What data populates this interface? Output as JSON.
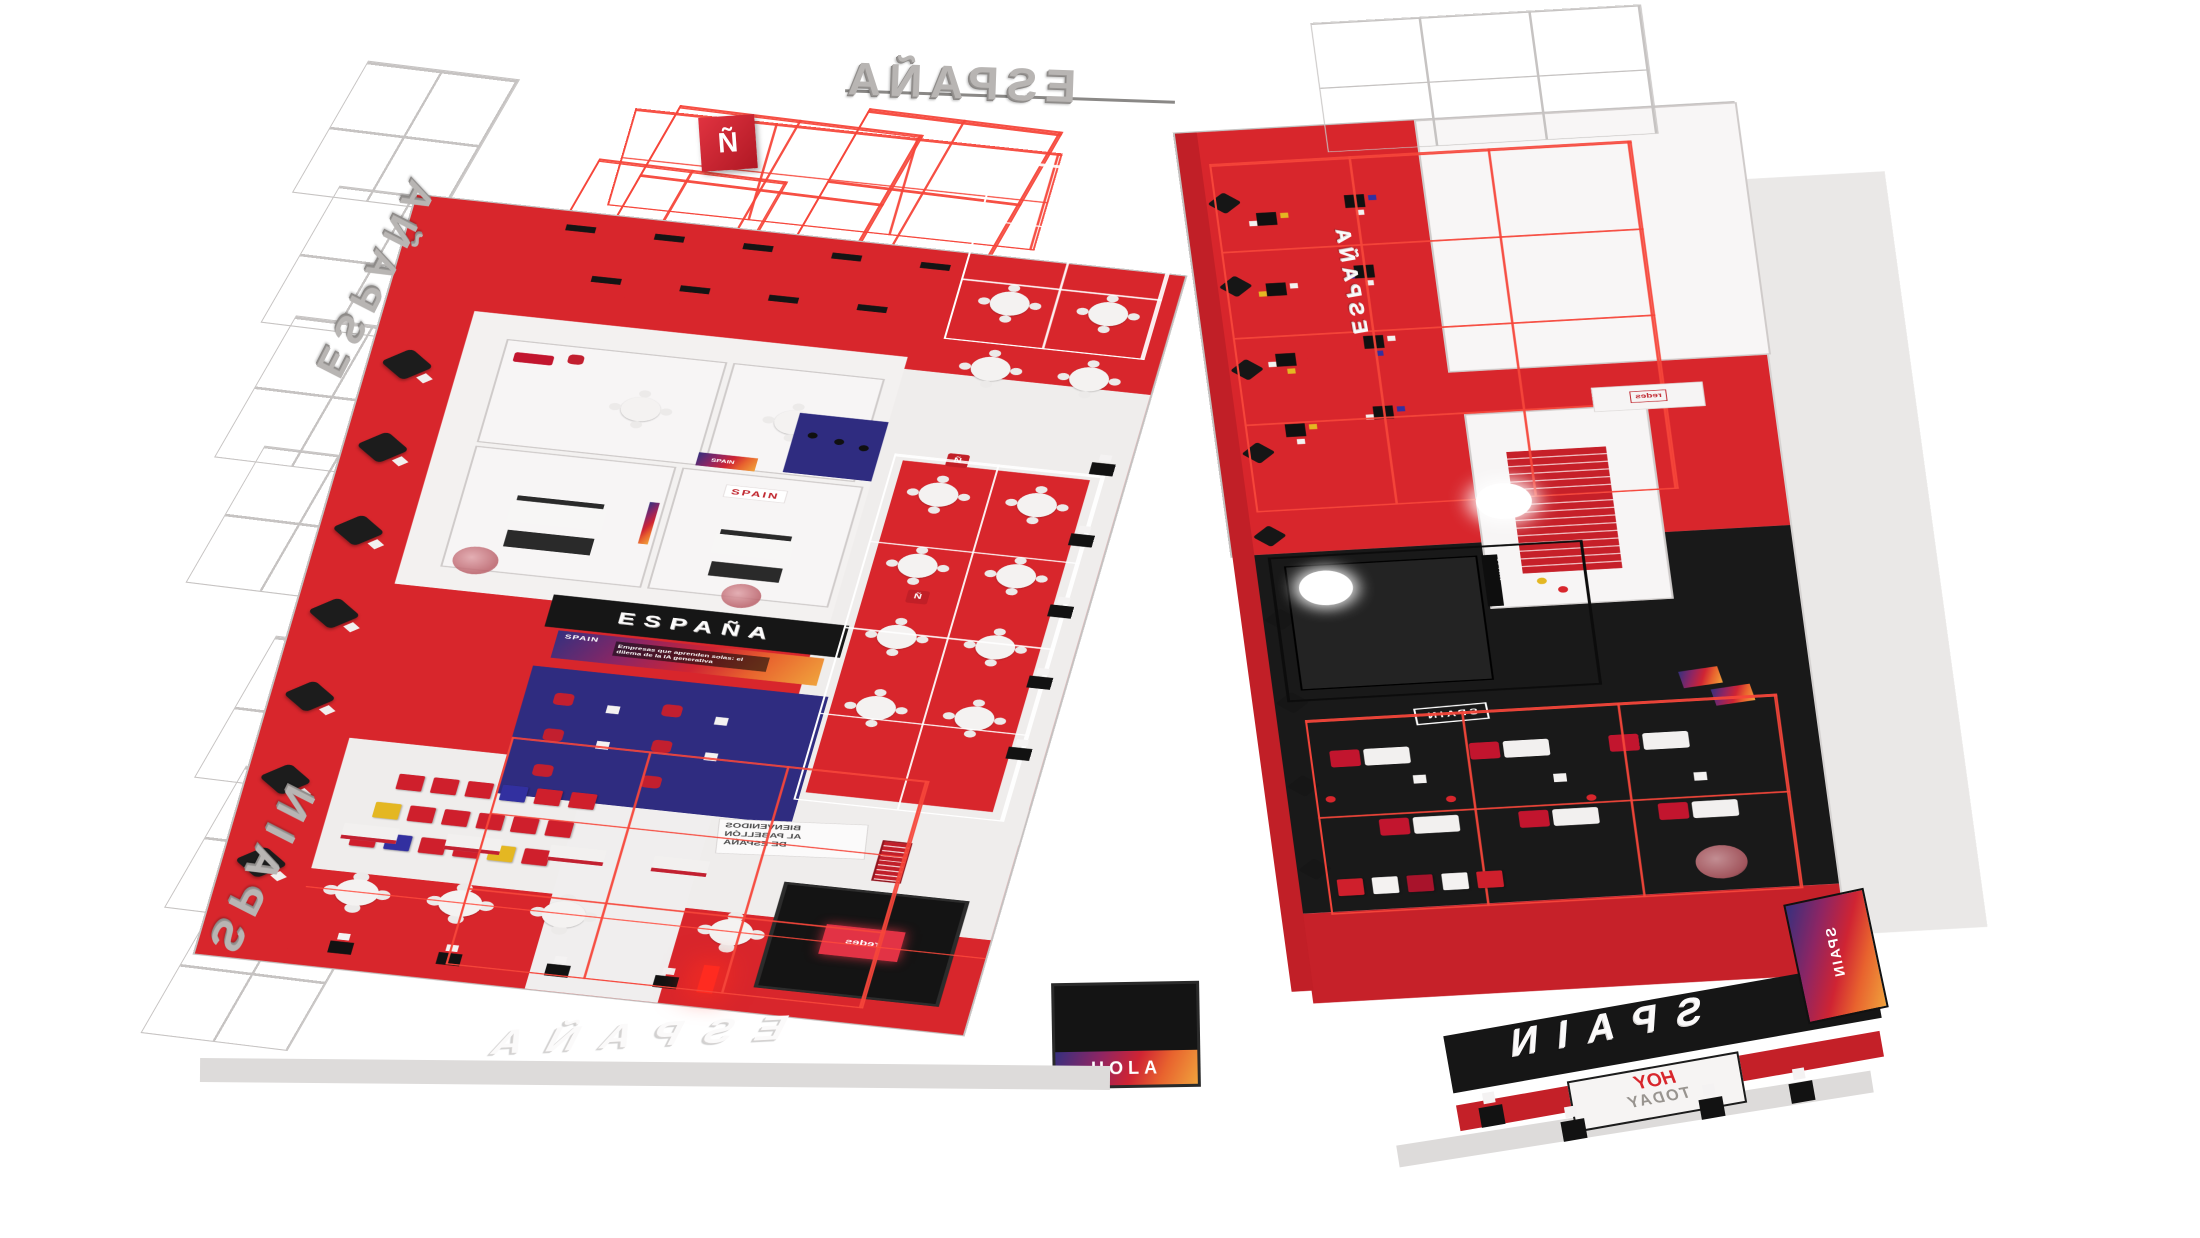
{
  "scene": {
    "description": "Two isometric 3D renders of the Spain exhibition pavilion (Pabellón de España)",
    "background": "#ffffff"
  },
  "palette": {
    "red": "#d8262c",
    "dark_red": "#c11f27",
    "wireframe_red": "#f6463a",
    "navy_carpet": "#2f2c80",
    "black": "#161616",
    "stool_yellow": "#e4b722",
    "stool_blue": "#3230a0",
    "light_floor": "#efedec",
    "gray_letters": "#b8b5b3"
  },
  "left_pavilion": {
    "overhead_letters": "ESPAÑA",
    "truss_letters_upper": "ESPAÑA",
    "truss_letters_lower": "SPAIN",
    "n_cube_letter": "Ñ",
    "stage": {
      "title": "ESPAÑA",
      "screen_brand": "SPAIN",
      "screen_caption": "Empresas que aprenden solas: el dilema de la IA generativa"
    },
    "meeting_room_logo": "SPAIN",
    "pod_badge_letter": "Ñ",
    "welcome_sign": {
      "line1": "BIENVENIDOS",
      "line2": "AL PABELLÓN",
      "line3": "DE ESPAÑA"
    },
    "immersive_screen_label": "redes",
    "entrance_floor_letters": "ESPAÑA",
    "hola_box_label": "HOLA"
  },
  "right_pavilion": {
    "side_wall_letters": "ESPAÑA",
    "fascia_letters": "SPAIN",
    "today_sign": {
      "line1": "HOY",
      "line2": "TODAY"
    },
    "floor_decal": "SPAIN",
    "kitchen_banner": "SPAIN",
    "wall_poster_brand": "SPAIN",
    "counter_sign": "redes"
  }
}
